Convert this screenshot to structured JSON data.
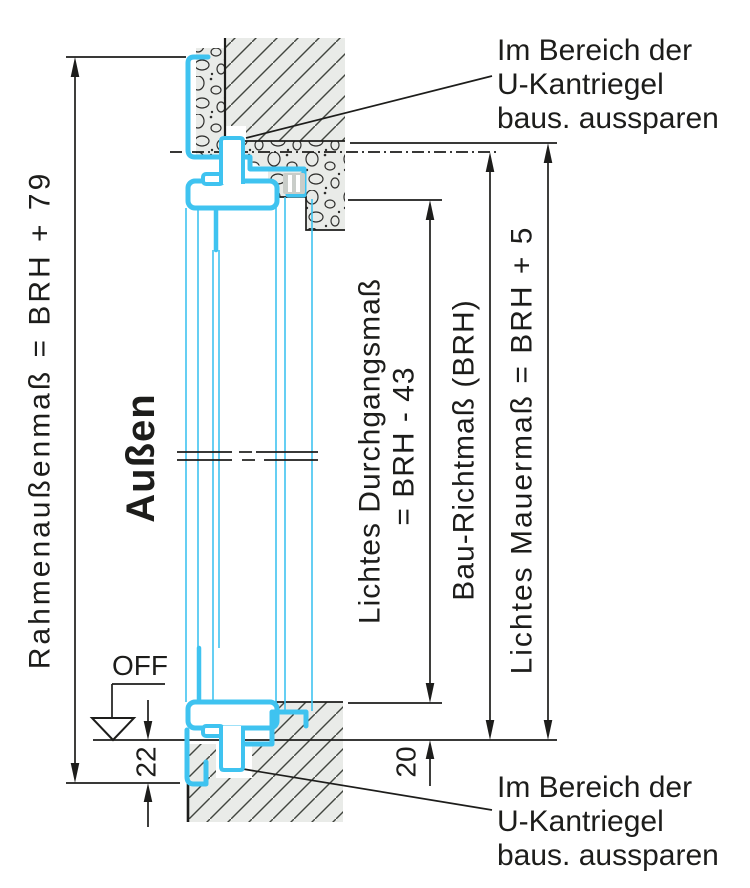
{
  "drawing": {
    "orientation_label": "Außen",
    "floor_level_label": "OFF",
    "dims": {
      "frame_outer": "Rahmenaußenmaß = BRH + 79",
      "clear_passage_line1": "Lichtes Durchgangsmaß",
      "clear_passage_line2": "= BRH - 43",
      "build_reference": "Bau-Richtmaß (BRH)",
      "clear_masonry": "Lichtes Mauermaß = BRH + 5",
      "bottom_left_offset": "22",
      "bottom_right_offset": "20"
    },
    "annotations": {
      "top": [
        "Im Bereich der",
        "U-Kantriegel",
        "baus. aussparen"
      ],
      "bottom": [
        "Im Bereich der",
        "U-Kantriegel",
        "baus. aussparen"
      ]
    },
    "colors": {
      "frame": "#3fc3f0",
      "fill_light": "#e9ebe8",
      "keeper_gray": "#c9cdc9",
      "line": "#1d1d1b",
      "background": "#ffffff"
    }
  }
}
